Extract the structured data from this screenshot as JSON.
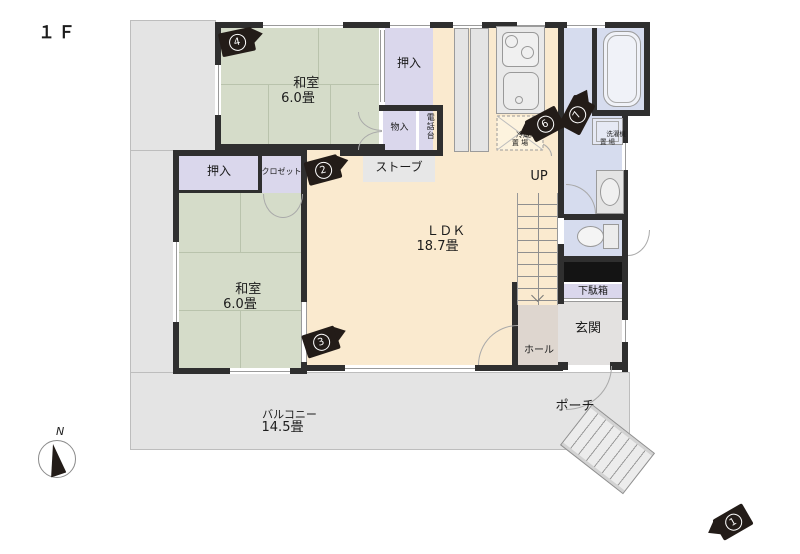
{
  "floor_label": "１Ｆ",
  "compass": {
    "north_label": "N"
  },
  "rooms": {
    "washitsu_top": {
      "name": "和室",
      "size": "6.0畳"
    },
    "washitsu_lower": {
      "name": "和室",
      "size": "6.0畳"
    },
    "ldk": {
      "name": "ＬＤＫ",
      "size": "18.7畳"
    },
    "balcony": {
      "name": "バルコニー",
      "size": "14.5畳"
    },
    "porch": "ポーチ",
    "genkan": "玄関",
    "hall": "ホール",
    "getabako": "下駄箱",
    "oshiire_top": "押入",
    "oshiire_lower": "押入",
    "closet": "クロゼット",
    "monoire": "物入",
    "phone_stand": "電話台",
    "stove": "ストーブ",
    "stairs_up": "UP",
    "fridge_space": {
      "line1": "冷蔵庫",
      "line2": "置 場"
    },
    "washer_space": {
      "line1": "洗濯機",
      "line2": "置 場"
    }
  },
  "markers": [
    {
      "number": "1"
    },
    {
      "number": "2"
    },
    {
      "number": "3"
    },
    {
      "number": "4"
    },
    {
      "number": "6"
    },
    {
      "number": "7"
    }
  ],
  "colors": {
    "tatami": "#d5dcc9",
    "closet": "#dad7ec",
    "ldk": "#faeacf",
    "wet_area": "#d6dcee",
    "balcony": "#e4e4e4",
    "wall": "#2f2f2f",
    "hall": "#ded6cf",
    "genkan": "#e3e1e0",
    "marker_body": "#231c18"
  }
}
